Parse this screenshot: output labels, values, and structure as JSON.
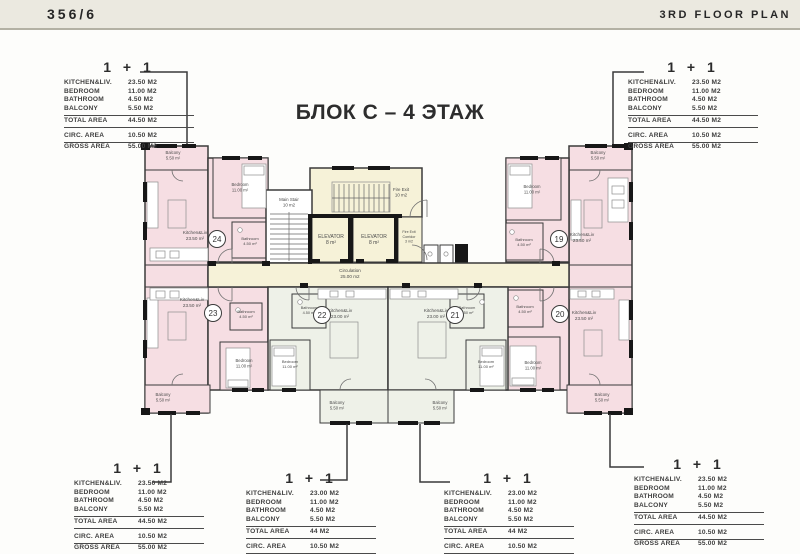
{
  "header": {
    "left": "356/6",
    "right": "3RD FLOOR PLAN"
  },
  "title": "БЛОК С – 4 ЭТАЖ",
  "colors": {
    "room_pink": "#f6dee3",
    "room_cream": "#f6f2d8",
    "room_green": "#eef1e8",
    "wall": "#3b3b3b",
    "topbar": "#ebe9e0"
  },
  "tables": [
    {
      "id": "top-left",
      "unit": "1 + 1",
      "rows": [
        [
          "KITCHEN&LIV.",
          "23.50 M2"
        ],
        [
          "BEDROOM",
          "11.00 M2"
        ],
        [
          "BATHROOM",
          "4.50 M2"
        ],
        [
          "BALCONY",
          "5.50 M2"
        ]
      ],
      "total": [
        "TOTAL AREA",
        "44.50 M2"
      ],
      "circ": [
        "CIRC. AREA",
        "10.50 M2"
      ],
      "gross": [
        "GROSS AREA",
        "55.00 M2"
      ]
    },
    {
      "id": "top-right",
      "unit": "1 + 1",
      "rows": [
        [
          "KITCHEN&LIV.",
          "23.50 M2"
        ],
        [
          "BEDROOM",
          "11.00 M2"
        ],
        [
          "BATHROOM",
          "4.50 M2"
        ],
        [
          "BALCONY",
          "5.50 M2"
        ]
      ],
      "total": [
        "TOTAL AREA",
        "44.50 M2"
      ],
      "circ": [
        "CIRC. AREA",
        "10.50 M2"
      ],
      "gross": [
        "GROSS AREA",
        "55.00 M2"
      ]
    },
    {
      "id": "bottom-1",
      "unit": "1 + 1",
      "rows": [
        [
          "KITCHEN&LIV.",
          "23.50 M2"
        ],
        [
          "BEDROOM",
          "11.00 M2"
        ],
        [
          "BATHROOM",
          "4.50 M2"
        ],
        [
          "BALCONY",
          "5.50 M2"
        ]
      ],
      "total": [
        "TOTAL AREA",
        "44.50 M2"
      ],
      "circ": [
        "CIRC. AREA",
        "10.50 M2"
      ],
      "gross": [
        "GROSS AREA",
        "55.00 M2"
      ]
    },
    {
      "id": "bottom-2",
      "unit": "1 + 1",
      "rows": [
        [
          "KITCHEN&LIV.",
          "23.00 M2"
        ],
        [
          "BEDROOM",
          "11.00 M2"
        ],
        [
          "BATHROOM",
          "4.50 M2"
        ],
        [
          "BALCONY",
          "5.50 M2"
        ]
      ],
      "total": [
        "TOTAL AREA",
        "44 M2"
      ],
      "circ": [
        "CIRC. AREA",
        "10.50 M2"
      ],
      "gross": [
        "GROSS AREA",
        "54.50 M2"
      ]
    },
    {
      "id": "bottom-3",
      "unit": "1 + 1",
      "rows": [
        [
          "KITCHEN&LIV.",
          "23.00 M2"
        ],
        [
          "BEDROOM",
          "11.00 M2"
        ],
        [
          "BATHROOM",
          "4.50 M2"
        ],
        [
          "BALCONY",
          "5.50 M2"
        ]
      ],
      "total": [
        "TOTAL AREA",
        "44 M2"
      ],
      "circ": [
        "CIRC. AREA",
        "10.50 M2"
      ],
      "gross": [
        "GROSS AREA",
        "54.50 M2"
      ]
    },
    {
      "id": "bottom-4",
      "unit": "1 + 1",
      "rows": [
        [
          "KITCHEN&LIV.",
          "23.50 M2"
        ],
        [
          "BEDROOM",
          "11.00 M2"
        ],
        [
          "BATHROOM",
          "4.50 M2"
        ],
        [
          "BALCONY",
          "5.50 M2"
        ]
      ],
      "total": [
        "TOTAL AREA",
        "44.50 M2"
      ],
      "circ": [
        "CIRC. AREA",
        "10.50 M2"
      ],
      "gross": [
        "GROSS AREA",
        "55.00 M2"
      ]
    }
  ],
  "plan": {
    "unit_circles": [
      {
        "n": "24",
        "x": 217,
        "y": 239
      },
      {
        "n": "23",
        "x": 213,
        "y": 313
      },
      {
        "n": "22",
        "x": 322,
        "y": 315
      },
      {
        "n": "21",
        "x": 455,
        "y": 315
      },
      {
        "n": "19",
        "x": 559,
        "y": 239
      },
      {
        "n": "20",
        "x": 560,
        "y": 314
      }
    ],
    "labels": [
      {
        "x": 173,
        "y": 154,
        "s": 4.2,
        "lines": [
          "Balcony",
          "5.50 m²"
        ]
      },
      {
        "x": 195,
        "y": 234,
        "s": 4.6,
        "lines": [
          "Kitchen&Liv",
          "23.50 m²"
        ]
      },
      {
        "x": 240,
        "y": 186,
        "s": 4.2,
        "lines": [
          "Bedroom",
          "11.00 m²"
        ]
      },
      {
        "x": 250,
        "y": 240,
        "s": 4.0,
        "lines": [
          "Bathroom",
          "4.50 m²"
        ]
      },
      {
        "x": 192,
        "y": 301,
        "s": 4.6,
        "lines": [
          "Kitchen&Liv",
          "23.50 m²"
        ]
      },
      {
        "x": 244,
        "y": 362,
        "s": 4.2,
        "lines": [
          "Bedroom",
          "11.00 m²"
        ]
      },
      {
        "x": 246,
        "y": 313,
        "s": 4.0,
        "lines": [
          "Bathroom",
          "4.50 m²"
        ]
      },
      {
        "x": 163,
        "y": 396,
        "s": 4.2,
        "lines": [
          "Balcony",
          "5.50 m²"
        ]
      },
      {
        "x": 289,
        "y": 201,
        "s": 4.4,
        "lines": [
          "Main Stair",
          "10 m2"
        ]
      },
      {
        "x": 401,
        "y": 191,
        "s": 4.4,
        "lines": [
          "Fire Exit",
          "10 m2"
        ]
      },
      {
        "x": 331,
        "y": 238,
        "s": 5.0,
        "lines": [
          "ELEVATOR",
          "8 m²"
        ]
      },
      {
        "x": 374,
        "y": 238,
        "s": 5.0,
        "lines": [
          "ELEVATOR",
          "8 m²"
        ]
      },
      {
        "x": 409,
        "y": 233,
        "s": 3.6,
        "lines": [
          "Fire Exit",
          "Corridor",
          "3 m2"
        ]
      },
      {
        "x": 350,
        "y": 272,
        "s": 4.6,
        "lines": [
          "Circulation",
          "25.00 m2"
        ]
      },
      {
        "x": 340,
        "y": 312,
        "s": 4.6,
        "lines": [
          "Kitchen&Liv",
          "23.00 m²"
        ]
      },
      {
        "x": 290,
        "y": 363,
        "s": 4.0,
        "lines": [
          "Bedroom",
          "11.00 m²"
        ]
      },
      {
        "x": 309,
        "y": 309,
        "s": 3.8,
        "lines": [
          "Bathroom",
          "4.50 m²"
        ]
      },
      {
        "x": 337,
        "y": 404,
        "s": 4.2,
        "lines": [
          "Balcony",
          "5.50 m²"
        ]
      },
      {
        "x": 436,
        "y": 312,
        "s": 4.6,
        "lines": [
          "Kitchen&Liv",
          "23.00 m²"
        ]
      },
      {
        "x": 486,
        "y": 363,
        "s": 4.0,
        "lines": [
          "Bedroom",
          "11.00 m²"
        ]
      },
      {
        "x": 467,
        "y": 309,
        "s": 3.8,
        "lines": [
          "Bathroom",
          "4.50 m²"
        ]
      },
      {
        "x": 440,
        "y": 404,
        "s": 4.2,
        "lines": [
          "Balcony",
          "5.50 m²"
        ]
      },
      {
        "x": 582,
        "y": 236,
        "s": 4.6,
        "lines": [
          "Kitchen&Liv",
          "23.50 m²"
        ]
      },
      {
        "x": 532,
        "y": 188,
        "s": 4.2,
        "lines": [
          "Bedroom",
          "11.00 m²"
        ]
      },
      {
        "x": 524,
        "y": 241,
        "s": 4.0,
        "lines": [
          "Bathroom",
          "4.50 m²"
        ]
      },
      {
        "x": 598,
        "y": 154,
        "s": 4.2,
        "lines": [
          "Balcony",
          "5.50 m²"
        ]
      },
      {
        "x": 584,
        "y": 314,
        "s": 4.6,
        "lines": [
          "Kitchen&Liv",
          "23.50 m²"
        ]
      },
      {
        "x": 533,
        "y": 364,
        "s": 4.2,
        "lines": [
          "Bedroom",
          "11.00 m²"
        ]
      },
      {
        "x": 525,
        "y": 308,
        "s": 4.0,
        "lines": [
          "Bathroom",
          "4.50 m²"
        ]
      },
      {
        "x": 602,
        "y": 396,
        "s": 4.2,
        "lines": [
          "Balcony",
          "5.50 m²"
        ]
      }
    ],
    "leaders": [
      {
        "points": "140,72 187,72 187,144"
      },
      {
        "points": "644,72 613,72 613,144"
      },
      {
        "points": "152,482 171,482 171,414"
      },
      {
        "points": "320,480 347,480 347,424"
      },
      {
        "points": "450,482 420,482 420,424"
      },
      {
        "points": "644,467 610,467 610,414"
      }
    ]
  }
}
